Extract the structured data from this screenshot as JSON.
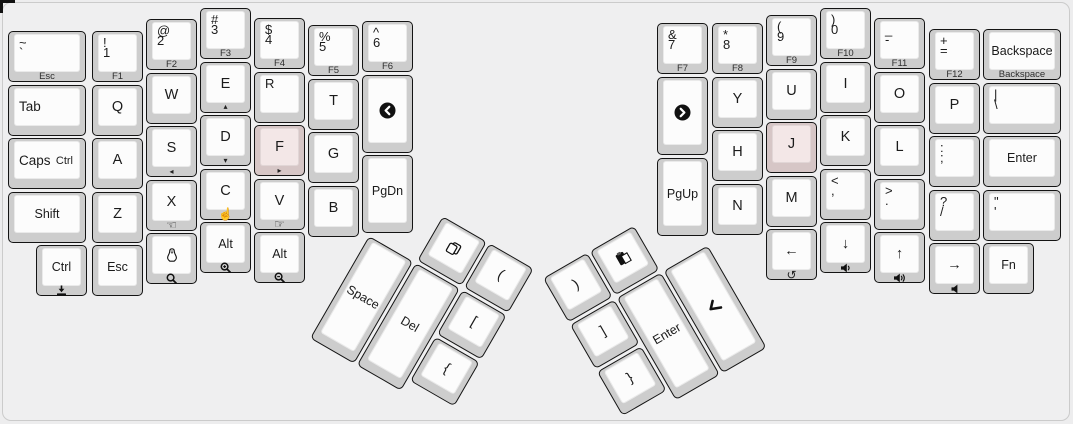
{
  "app": "keyboard-layout-canvas",
  "colors": {
    "page_bg": "#ededee",
    "canvas_bg": "#efeff0",
    "canvas_border": "#cbcbcb",
    "cap_side": "#cdcdcd",
    "cap_top": "#fcfcfc",
    "homing_cap_side": "#d6c6c6",
    "homing_cap_top": "#f3e7e7",
    "legend": "#1b1b1b",
    "key_border": "#141414",
    "icon": "#111111"
  },
  "left_hand": {
    "keys": [
      {
        "id": "tilde",
        "x": 8,
        "y": 31,
        "w": 78,
        "legends": {
          "line1": "~",
          "line2": "`",
          "front": "Esc"
        }
      },
      {
        "id": "1",
        "x": 92,
        "y": 31,
        "legends": {
          "line1": "!",
          "line2": "1",
          "front": "F1"
        }
      },
      {
        "id": "2",
        "x": 146,
        "y": 19,
        "legends": {
          "line1": "@",
          "line2": "2",
          "front": "F2"
        }
      },
      {
        "id": "3",
        "x": 200,
        "y": 8,
        "legends": {
          "line1": "#",
          "line2": "3",
          "front": "F3"
        }
      },
      {
        "id": "4",
        "x": 254,
        "y": 18,
        "legends": {
          "line1": "$",
          "line2": "4",
          "front": "F4"
        }
      },
      {
        "id": "5",
        "x": 308,
        "y": 25,
        "legends": {
          "line1": "%",
          "line2": "5",
          "front": "F5"
        }
      },
      {
        "id": "6",
        "x": 362,
        "y": 21,
        "legends": {
          "line1": "^",
          "line2": "6",
          "front": "F6"
        }
      },
      {
        "id": "tab",
        "x": 8,
        "y": 84.5,
        "w": 78,
        "legends": {
          "left": "Tab"
        }
      },
      {
        "id": "q",
        "x": 92,
        "y": 84.5,
        "legends": {
          "center": "Q"
        }
      },
      {
        "id": "w",
        "x": 146,
        "y": 72.5,
        "legends": {
          "center": "W"
        }
      },
      {
        "id": "e",
        "x": 200,
        "y": 61.5,
        "legends": {
          "center": "E"
        },
        "front_icon": "triangle-up"
      },
      {
        "id": "r",
        "x": 254,
        "y": 71.5,
        "legends": {
          "line1": "R"
        }
      },
      {
        "id": "t",
        "x": 308,
        "y": 78.5,
        "legends": {
          "center": "T"
        }
      },
      {
        "id": "layer-left",
        "x": 362,
        "y": 74.5,
        "h": 78,
        "icon": "chevron-circle-left"
      },
      {
        "id": "caps",
        "x": 8,
        "y": 138,
        "w": 78,
        "legends": {
          "left": "Caps",
          "inner_br": "Ctrl"
        }
      },
      {
        "id": "a",
        "x": 92,
        "y": 138,
        "legends": {
          "center": "A"
        }
      },
      {
        "id": "s",
        "x": 146,
        "y": 126,
        "legends": {
          "center": "S"
        },
        "front_icon": "triangle-left"
      },
      {
        "id": "d",
        "x": 200,
        "y": 115,
        "legends": {
          "center": "D"
        },
        "front_icon": "triangle-down"
      },
      {
        "id": "f",
        "x": 254,
        "y": 125,
        "homing": true,
        "legends": {
          "center": "F"
        },
        "front_icon": "triangle-right"
      },
      {
        "id": "g",
        "x": 308,
        "y": 132,
        "legends": {
          "center": "G"
        }
      },
      {
        "id": "pgdn",
        "x": 362,
        "y": 155,
        "h": 78,
        "legends": {
          "center": "PgDn"
        }
      },
      {
        "id": "shift",
        "x": 8,
        "y": 191.5,
        "w": 78,
        "legends": {
          "center": "Shift"
        }
      },
      {
        "id": "z",
        "x": 92,
        "y": 191.5,
        "legends": {
          "center": "Z"
        }
      },
      {
        "id": "x",
        "x": 146,
        "y": 179.5,
        "legends": {
          "center": "X"
        },
        "front_icon": "hand-left"
      },
      {
        "id": "c",
        "x": 200,
        "y": 168.5,
        "legends": {
          "center": "C"
        },
        "front_icon": "hand-up"
      },
      {
        "id": "v",
        "x": 254,
        "y": 178.5,
        "legends": {
          "center": "V"
        },
        "front_icon": "hand-right"
      },
      {
        "id": "b",
        "x": 308,
        "y": 185.5,
        "legends": {
          "center": "B"
        }
      },
      {
        "id": "ctrl",
        "x": 36,
        "y": 245,
        "legends": {
          "center": "Ctrl"
        },
        "front_icon": "download"
      },
      {
        "id": "esc",
        "x": 92,
        "y": 245,
        "legends": {
          "center": "Esc"
        }
      },
      {
        "id": "linux",
        "x": 146,
        "y": 233,
        "icon": "linux",
        "front_icon": "search"
      },
      {
        "id": "alt-left-1",
        "x": 200,
        "y": 222,
        "legends": {
          "center": "Alt"
        },
        "front_icon": "search-plus"
      },
      {
        "id": "alt-left-2",
        "x": 254,
        "y": 232,
        "legends": {
          "center": "Alt"
        },
        "front_icon": "search-minus"
      }
    ]
  },
  "right_hand": {
    "keys": [
      {
        "id": "7",
        "x": 657,
        "y": 23,
        "legends": {
          "line1": "&",
          "line2": "7",
          "front": "F7"
        }
      },
      {
        "id": "8",
        "x": 712,
        "y": 23,
        "legends": {
          "line1": "*",
          "line2": "8",
          "front": "F8"
        }
      },
      {
        "id": "9",
        "x": 766,
        "y": 15,
        "legends": {
          "line1": "(",
          "line2": "9",
          "front": "F9"
        }
      },
      {
        "id": "0",
        "x": 820,
        "y": 8,
        "legends": {
          "line1": ")",
          "line2": "0",
          "front": "F10"
        }
      },
      {
        "id": "minus",
        "x": 874,
        "y": 18,
        "legends": {
          "line1": "_",
          "line2": "-",
          "front": "F11"
        }
      },
      {
        "id": "equals",
        "x": 929,
        "y": 29,
        "legends": {
          "line1": "+",
          "line2": "=",
          "front": "F12"
        }
      },
      {
        "id": "backspace",
        "x": 983,
        "y": 29,
        "w": 78,
        "legends": {
          "center": "Backspace",
          "front": "Backspace"
        }
      },
      {
        "id": "layer-right",
        "x": 657,
        "y": 76.5,
        "h": 78,
        "icon": "chevron-circle-right"
      },
      {
        "id": "y",
        "x": 712,
        "y": 76.5,
        "legends": {
          "center": "Y"
        }
      },
      {
        "id": "u",
        "x": 766,
        "y": 68.5,
        "legends": {
          "center": "U"
        }
      },
      {
        "id": "i",
        "x": 820,
        "y": 61.5,
        "legends": {
          "center": "I"
        }
      },
      {
        "id": "o",
        "x": 874,
        "y": 71.5,
        "legends": {
          "center": "O"
        }
      },
      {
        "id": "p",
        "x": 929,
        "y": 82.5,
        "legends": {
          "center": "P"
        }
      },
      {
        "id": "backslash",
        "x": 983,
        "y": 82.5,
        "w": 78,
        "legends": {
          "line1": "|",
          "line2": "\\"
        }
      },
      {
        "id": "pgup",
        "x": 657,
        "y": 158,
        "h": 78,
        "legends": {
          "center": "PgUp"
        }
      },
      {
        "id": "h",
        "x": 712,
        "y": 130,
        "legends": {
          "center": "H"
        }
      },
      {
        "id": "j",
        "x": 766,
        "y": 122,
        "homing": true,
        "legends": {
          "center": "J"
        }
      },
      {
        "id": "k",
        "x": 820,
        "y": 115,
        "legends": {
          "center": "K"
        }
      },
      {
        "id": "l",
        "x": 874,
        "y": 125,
        "legends": {
          "center": "L"
        }
      },
      {
        "id": "semicolon",
        "x": 929,
        "y": 136,
        "legends": {
          "line1": ":",
          "line2": ";"
        }
      },
      {
        "id": "enter",
        "x": 983,
        "y": 136,
        "w": 78,
        "legends": {
          "center": "Enter"
        }
      },
      {
        "id": "n",
        "x": 712,
        "y": 183.5,
        "legends": {
          "center": "N"
        }
      },
      {
        "id": "m",
        "x": 766,
        "y": 175.5,
        "legends": {
          "center": "M"
        }
      },
      {
        "id": "comma",
        "x": 820,
        "y": 168.5,
        "legends": {
          "line1": "<",
          "line2": ","
        }
      },
      {
        "id": "period",
        "x": 874,
        "y": 178.5,
        "legends": {
          "line1": ">",
          "line2": "."
        }
      },
      {
        "id": "slash",
        "x": 929,
        "y": 189.5,
        "legends": {
          "line1": "?",
          "line2": "/"
        }
      },
      {
        "id": "quote",
        "x": 983,
        "y": 189.5,
        "w": 78,
        "legends": {
          "line1": "\"",
          "line2": "'"
        }
      },
      {
        "id": "arrow-left",
        "x": 766,
        "y": 229,
        "legends": {
          "center": "←"
        },
        "front_icon": "undo"
      },
      {
        "id": "arrow-down",
        "x": 820,
        "y": 222,
        "legends": {
          "center": "↓"
        },
        "front_icon": "volume-down"
      },
      {
        "id": "arrow-up",
        "x": 874,
        "y": 232,
        "legends": {
          "center": "↑"
        },
        "front_icon": "volume-up"
      },
      {
        "id": "arrow-right",
        "x": 929,
        "y": 243,
        "legends": {
          "center": "→"
        },
        "front_icon": "volume-mute"
      },
      {
        "id": "fn",
        "x": 983,
        "y": 243,
        "legends": {
          "center": "Fn"
        }
      }
    ]
  },
  "left_thumb": {
    "origin_x": 369,
    "origin_y": 236,
    "rotation": 30,
    "keys": [
      {
        "id": "space",
        "x": 0,
        "y": 0,
        "w": 51,
        "h": 118,
        "legends": {
          "center": "Space"
        }
      },
      {
        "id": "del",
        "x": 54,
        "y": 0,
        "w": 51,
        "h": 118,
        "legends": {
          "center": "Del"
        }
      },
      {
        "id": "copy",
        "x": 54,
        "y": -54,
        "icon": "copy"
      },
      {
        "id": "lparen",
        "x": 108,
        "y": -54,
        "legends": {
          "center": "("
        }
      },
      {
        "id": "lbracket",
        "x": 108,
        "y": 0,
        "legends": {
          "center": "["
        }
      },
      {
        "id": "lbrace",
        "x": 108,
        "y": 54,
        "legends": {
          "center": "{"
        }
      }
    ]
  },
  "right_thumb": {
    "origin_x": 570,
    "origin_y": 325,
    "rotation": -30,
    "keys": [
      {
        "id": "rparen",
        "x": 0,
        "y": -54,
        "legends": {
          "center": ")"
        }
      },
      {
        "id": "rbracket",
        "x": 0,
        "y": 0,
        "legends": {
          "center": "]"
        }
      },
      {
        "id": "rbrace",
        "x": 0,
        "y": 54,
        "legends": {
          "center": "}"
        }
      },
      {
        "id": "paste",
        "x": 54,
        "y": -54,
        "icon": "paste"
      },
      {
        "id": "enter-thumb",
        "x": 54,
        "y": 0,
        "w": 51,
        "h": 118,
        "legends": {
          "center": "Enter"
        }
      },
      {
        "id": "pointer",
        "x": 108,
        "y": 0,
        "w": 51,
        "h": 118,
        "icon": "cursor-check"
      }
    ]
  }
}
